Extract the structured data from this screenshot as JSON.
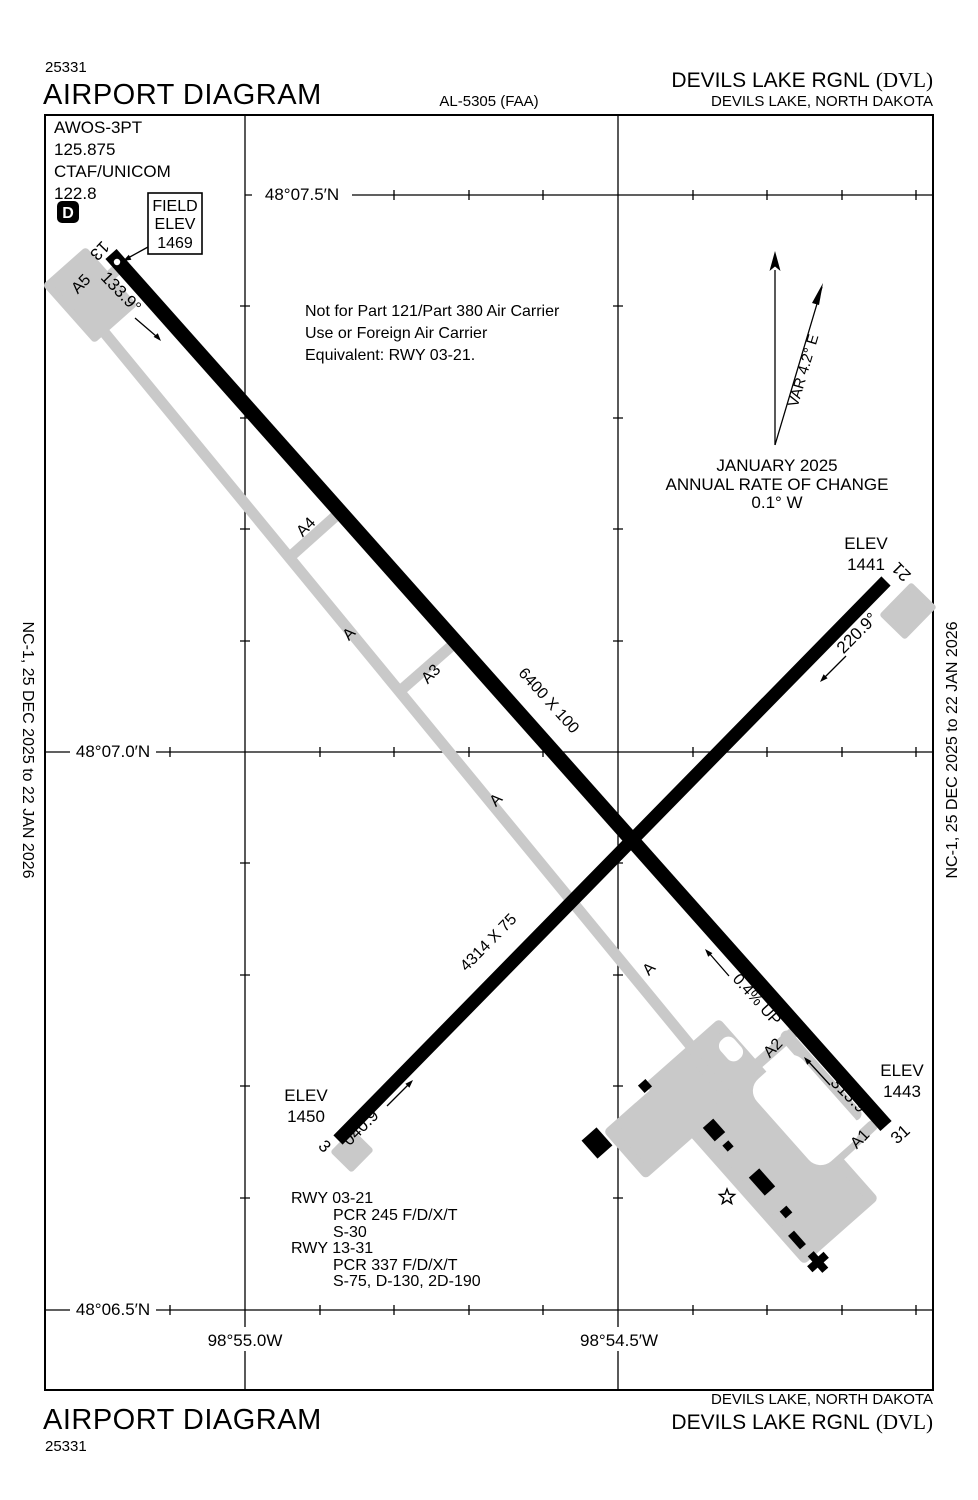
{
  "colors": {
    "ink": "#000000",
    "pavement": "#c9c9c9"
  },
  "header": {
    "chart_number": "25331",
    "title": "AIRPORT DIAGRAM",
    "al_ref": "AL-5305 (FAA)",
    "airport_name": "DEVILS LAKE RGNL",
    "airport_icao": "(DVL)",
    "city_state": "DEVILS LAKE, NORTH DAKOTA"
  },
  "footer": {
    "title": "AIRPORT DIAGRAM",
    "chart_number": "25331",
    "airport_name": "DEVILS LAKE RGNL",
    "airport_icao": "(DVL)",
    "city_state": "DEVILS LAKE, NORTH DAKOTA"
  },
  "margin_note": "NC-1,  25 DEC 2025  to  22 JAN 2026",
  "comms": {
    "awos_label": "AWOS-3PT",
    "awos_freq": "125.875",
    "ctaf_label": "CTAF/UNICOM",
    "ctaf_freq": "122.8",
    "d_badge": "D"
  },
  "field_elev": {
    "line1": "FIELD",
    "line2": "ELEV",
    "line3": "1469"
  },
  "notice": {
    "line1": "Not for Part 121/Part 380 Air Carrier",
    "line2": "Use or Foreign Air Carrier",
    "line3": "Equivalent: RWY 03-21."
  },
  "compass": {
    "variation": "VAR 4.2° E",
    "date": "JANUARY 2025",
    "rate_line1": "ANNUAL RATE OF CHANGE",
    "rate_line2": "0.1° W"
  },
  "graticule": {
    "lat": [
      "48°07.5′N",
      "48°07.0′N",
      "48°06.5′N"
    ],
    "lon": [
      "98°55.0W",
      "98°54.5′W"
    ]
  },
  "runway_13_31": {
    "number_13": "13",
    "number_31": "31",
    "dimensions": "6400 X 100",
    "heading_13": "133.9°",
    "heading_31": "313.9°",
    "slope": "0.4% UP"
  },
  "runway_03_21": {
    "number_3": "3",
    "number_21": "21",
    "dimensions": "4314 X 75",
    "heading_3": "040.9°",
    "heading_21": "220.9°"
  },
  "elevations": {
    "rwy21_label": "ELEV",
    "rwy21_value": "1441",
    "rwy3_label": "ELEV",
    "rwy3_value": "1450",
    "rwy31_label": "ELEV",
    "rwy31_value": "1443"
  },
  "taxiways": {
    "a5": "A5",
    "a4": "A4",
    "a_north": "A",
    "a3": "A3",
    "a_mid": "A",
    "a_south": "A",
    "a2": "A2",
    "a1": "A1"
  },
  "runway_data": {
    "line1": "RWY 03-21",
    "line2": "PCR 245 F/D/X/T",
    "line3": "S-30",
    "line4": "RWY 13-31",
    "line5": "PCR 337 F/D/X/T",
    "line6": "S-75, D-130, 2D-190"
  }
}
